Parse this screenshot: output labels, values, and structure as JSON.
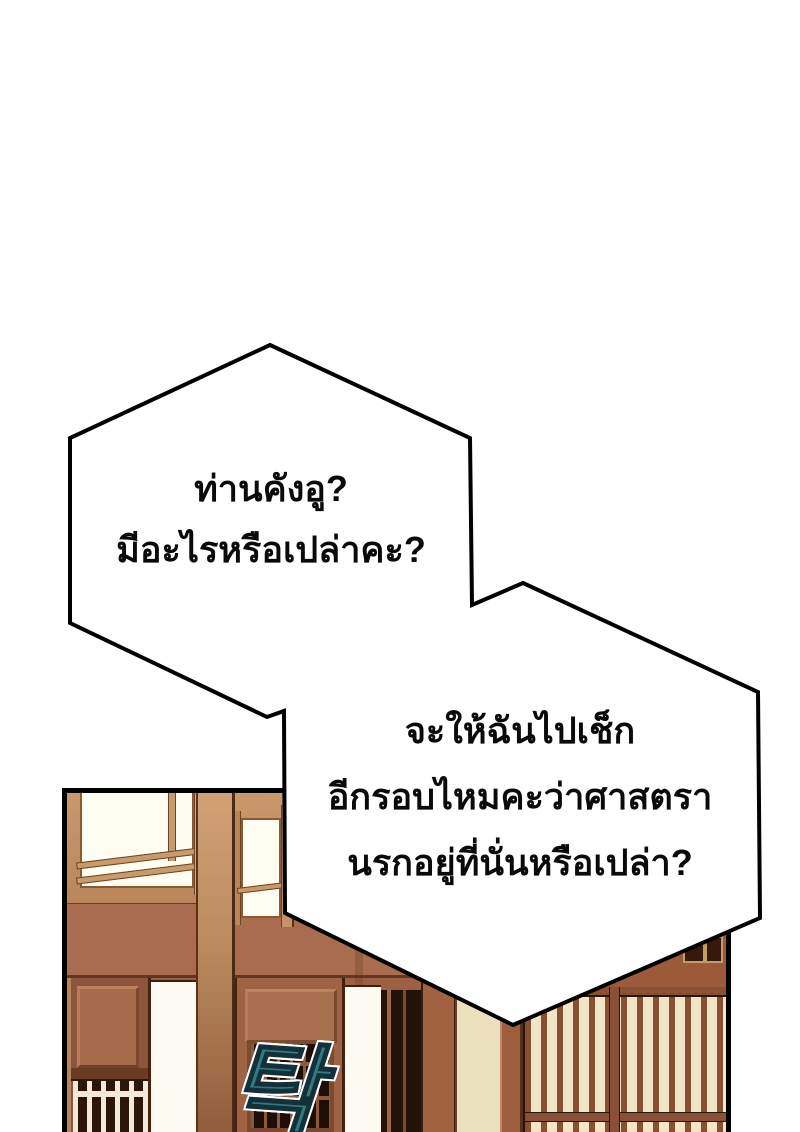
{
  "speech_bubbles": [
    {
      "lines": [
        "ท่านคังอู?",
        "มีอะไรหรือเปล่าคะ?"
      ]
    },
    {
      "lines": [
        "จะให้ฉันไปเช็ก",
        "อีกรอบไหมคะว่าศาสตรา",
        "นรกอยู่ที่นั่นหรือเปล่า?"
      ]
    }
  ],
  "sound_effect": {
    "text": "탁",
    "color": "#2f7c80"
  },
  "palette": {
    "page_background": "#ffffff",
    "bubble_fill": "#ffffff",
    "bubble_outline": "#000000",
    "panel_border": "#000000",
    "wall_tan": "#c2905f",
    "lintel_sienna": "#aa6c4e",
    "pillar_tan": "#d2a276",
    "door_brown": "#9e6244",
    "lattice_dark": "#1f0e05",
    "lattice_cream": "#f0e5c5",
    "slat_brown": "#8a4f33",
    "window_light": "#fffdf2"
  }
}
